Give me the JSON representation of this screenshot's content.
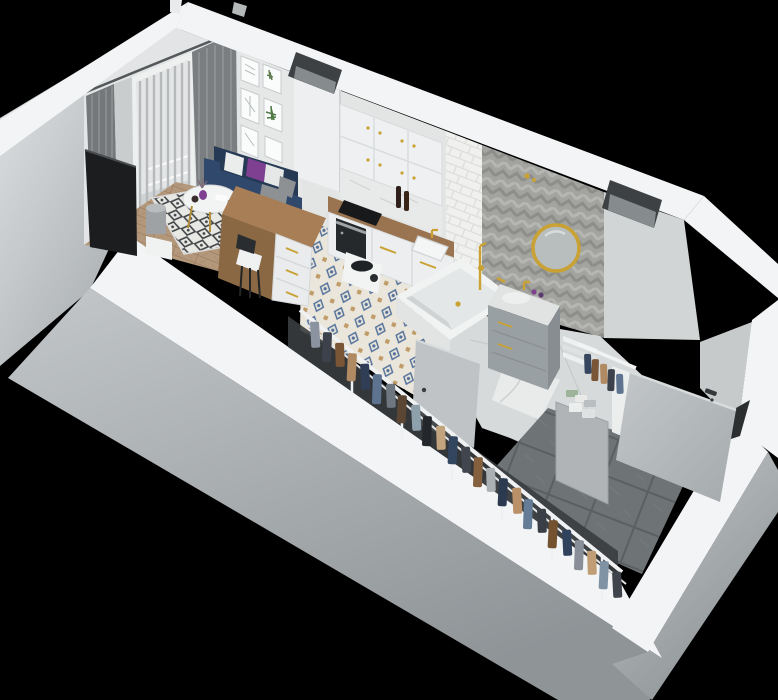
{
  "scene": {
    "title": "3D isometric cutaway render of a studio apartment floor plan",
    "style": "top-down axonometric render, open ceiling, black surround",
    "background": "#000000"
  },
  "palette": {
    "background": "#000000",
    "wall_top": "#f3f4f5",
    "wall_face": "#e2e4e5",
    "wall_face_dark": "#cdd0d1",
    "outer_light": "#e4e7e8",
    "outer_dark": "#979c9f",
    "gold": "#c9a233",
    "sofa_navy": "#30486b",
    "sofa_navy_dark": "#263955",
    "pillow_purple": "#804092",
    "tv_black": "#1b1d1f",
    "wood_counter": "#a67e55",
    "wood_floor": "#b4987b",
    "rug_line": "#3e4244",
    "curtain_dark": "#75787a",
    "blind_light": "#dcdedf",
    "chevron_gray": "#a3a4a0",
    "subway_white": "#f0f1ef",
    "kitchen_tile_blue": "#53719b",
    "hall_tile": "#6e7375",
    "door_gray": "#b6babc",
    "vent_dark": "#3e4143",
    "marble": "#e0e3e2",
    "vanity_gray": "#99a0a4",
    "mirror_glass": "#b8bdbd",
    "shadow": "#3a3d3f"
  },
  "rooms": {
    "living": {
      "label": "Living room",
      "items": [
        "wall-tv",
        "navy-sofa",
        "throw-pillows",
        "round-coffee-table",
        "dining-chairs",
        "diamond-pattern-rug",
        "floor-lamp",
        "side-table",
        "gray-curtains",
        "sheer-curtain",
        "balcony-door-with-blinds",
        "gallery-picture-wall",
        "herringbone-wood-floor"
      ]
    },
    "kitchen": {
      "label": "Kitchen",
      "items": [
        "upper-cabinets",
        "vent-duct",
        "marble-backsplash",
        "wood-countertop",
        "base-cabinets",
        "built-in-oven",
        "black-cooktop",
        "sink-with-gold-faucet",
        "wine-bottles",
        "kitchen-island-desk",
        "desk-chair",
        "coffee-machine",
        "patterned-cement-tile-floor"
      ]
    },
    "bathroom": {
      "label": "Bathroom",
      "items": [
        "built-in-bathtub",
        "gold-shower-set",
        "floating-vanity",
        "gold-round-mirror",
        "herringbone-chevron-wall",
        "subway-tile-wall",
        "bathroom-door",
        "ventilation-shaft",
        "cosmetic-bottles"
      ]
    },
    "hallway": {
      "label": "Entry hallway",
      "items": [
        "entrance-door",
        "door-handle",
        "large-gray-tile-floor",
        "gray-partition"
      ]
    },
    "wardrobe": {
      "label": "Open wardrobe corridor",
      "items": [
        "clothes-rail",
        "hanging-clothes",
        "shelf-unit",
        "folded-linen-stacks",
        "storage-boxes"
      ],
      "clothes": [
        {
          "x": 310,
          "y": 322,
          "h": 26,
          "tilt": -3,
          "color": "#8b93a1"
        },
        {
          "x": 323,
          "y": 332,
          "h": 30,
          "tilt": 2,
          "color": "#3c414b"
        },
        {
          "x": 335,
          "y": 343,
          "h": 24,
          "tilt": -2,
          "color": "#7b5636"
        },
        {
          "x": 348,
          "y": 353,
          "h": 28,
          "tilt": 3,
          "color": "#b08a62"
        },
        {
          "x": 360,
          "y": 364,
          "h": 26,
          "tilt": -3,
          "color": "#2f3e55"
        },
        {
          "x": 373,
          "y": 374,
          "h": 30,
          "tilt": 2,
          "color": "#5d7390"
        },
        {
          "x": 386,
          "y": 384,
          "h": 24,
          "tilt": -2,
          "color": "#6e7680"
        },
        {
          "x": 398,
          "y": 395,
          "h": 28,
          "tilt": 3,
          "color": "#5a4632"
        },
        {
          "x": 411,
          "y": 405,
          "h": 26,
          "tilt": -3,
          "color": "#8fa0ad"
        },
        {
          "x": 423,
          "y": 416,
          "h": 30,
          "tilt": 2,
          "color": "#23262b"
        },
        {
          "x": 436,
          "y": 426,
          "h": 24,
          "tilt": -2,
          "color": "#c2a47e"
        },
        {
          "x": 449,
          "y": 436,
          "h": 28,
          "tilt": 3,
          "color": "#33465f"
        },
        {
          "x": 461,
          "y": 447,
          "h": 26,
          "tilt": -3,
          "color": "#41464e"
        },
        {
          "x": 474,
          "y": 457,
          "h": 30,
          "tilt": 2,
          "color": "#84603f"
        },
        {
          "x": 486,
          "y": 468,
          "h": 24,
          "tilt": -2,
          "color": "#aab0b4"
        },
        {
          "x": 499,
          "y": 478,
          "h": 28,
          "tilt": 3,
          "color": "#2c3a50"
        },
        {
          "x": 512,
          "y": 488,
          "h": 26,
          "tilt": -3,
          "color": "#b99068"
        },
        {
          "x": 524,
          "y": 499,
          "h": 30,
          "tilt": 2,
          "color": "#647c96"
        },
        {
          "x": 537,
          "y": 509,
          "h": 24,
          "tilt": -2,
          "color": "#3a3f47"
        },
        {
          "x": 549,
          "y": 520,
          "h": 28,
          "tilt": 3,
          "color": "#75522f"
        },
        {
          "x": 562,
          "y": 530,
          "h": 26,
          "tilt": -3,
          "color": "#31425c"
        },
        {
          "x": 575,
          "y": 540,
          "h": 30,
          "tilt": 2,
          "color": "#888f98"
        },
        {
          "x": 587,
          "y": 551,
          "h": 24,
          "tilt": -2,
          "color": "#c09d74"
        },
        {
          "x": 600,
          "y": 561,
          "h": 28,
          "tilt": 3,
          "color": "#7f93a5"
        },
        {
          "x": 612,
          "y": 572,
          "h": 26,
          "tilt": -3,
          "color": "#3e434c"
        }
      ],
      "unit_clothes": [
        {
          "x": 584,
          "y": 354,
          "w": 7,
          "h": 20,
          "tilt": -2,
          "color": "#35465e"
        },
        {
          "x": 592,
          "y": 359,
          "w": 7,
          "h": 22,
          "tilt": 2,
          "color": "#7b5636"
        },
        {
          "x": 600,
          "y": 364,
          "w": 7,
          "h": 20,
          "tilt": -2,
          "color": "#b08a62"
        },
        {
          "x": 608,
          "y": 369,
          "w": 7,
          "h": 22,
          "tilt": 2,
          "color": "#3c414b"
        },
        {
          "x": 616,
          "y": 374,
          "w": 7,
          "h": 20,
          "tilt": -2,
          "color": "#5d7390"
        }
      ],
      "folded_stacks": [
        {
          "x": 566,
          "y": 390,
          "w": 12,
          "h": 7,
          "rx": 1,
          "color": "#9db39a"
        },
        {
          "x": 575,
          "y": 395,
          "w": 12,
          "h": 7,
          "rx": 1,
          "color": "#e9eae8"
        },
        {
          "x": 584,
          "y": 400,
          "w": 12,
          "h": 7,
          "rx": 1,
          "color": "#b9bec0"
        },
        {
          "x": 569,
          "y": 403,
          "w": 13,
          "h": 9,
          "rx": 1,
          "color": "#eceded"
        },
        {
          "x": 582,
          "y": 409,
          "w": 13,
          "h": 9,
          "rx": 1,
          "color": "#dfe2e3"
        }
      ]
    }
  },
  "vents": {
    "count": 2,
    "label": "ventilation-shaft"
  }
}
